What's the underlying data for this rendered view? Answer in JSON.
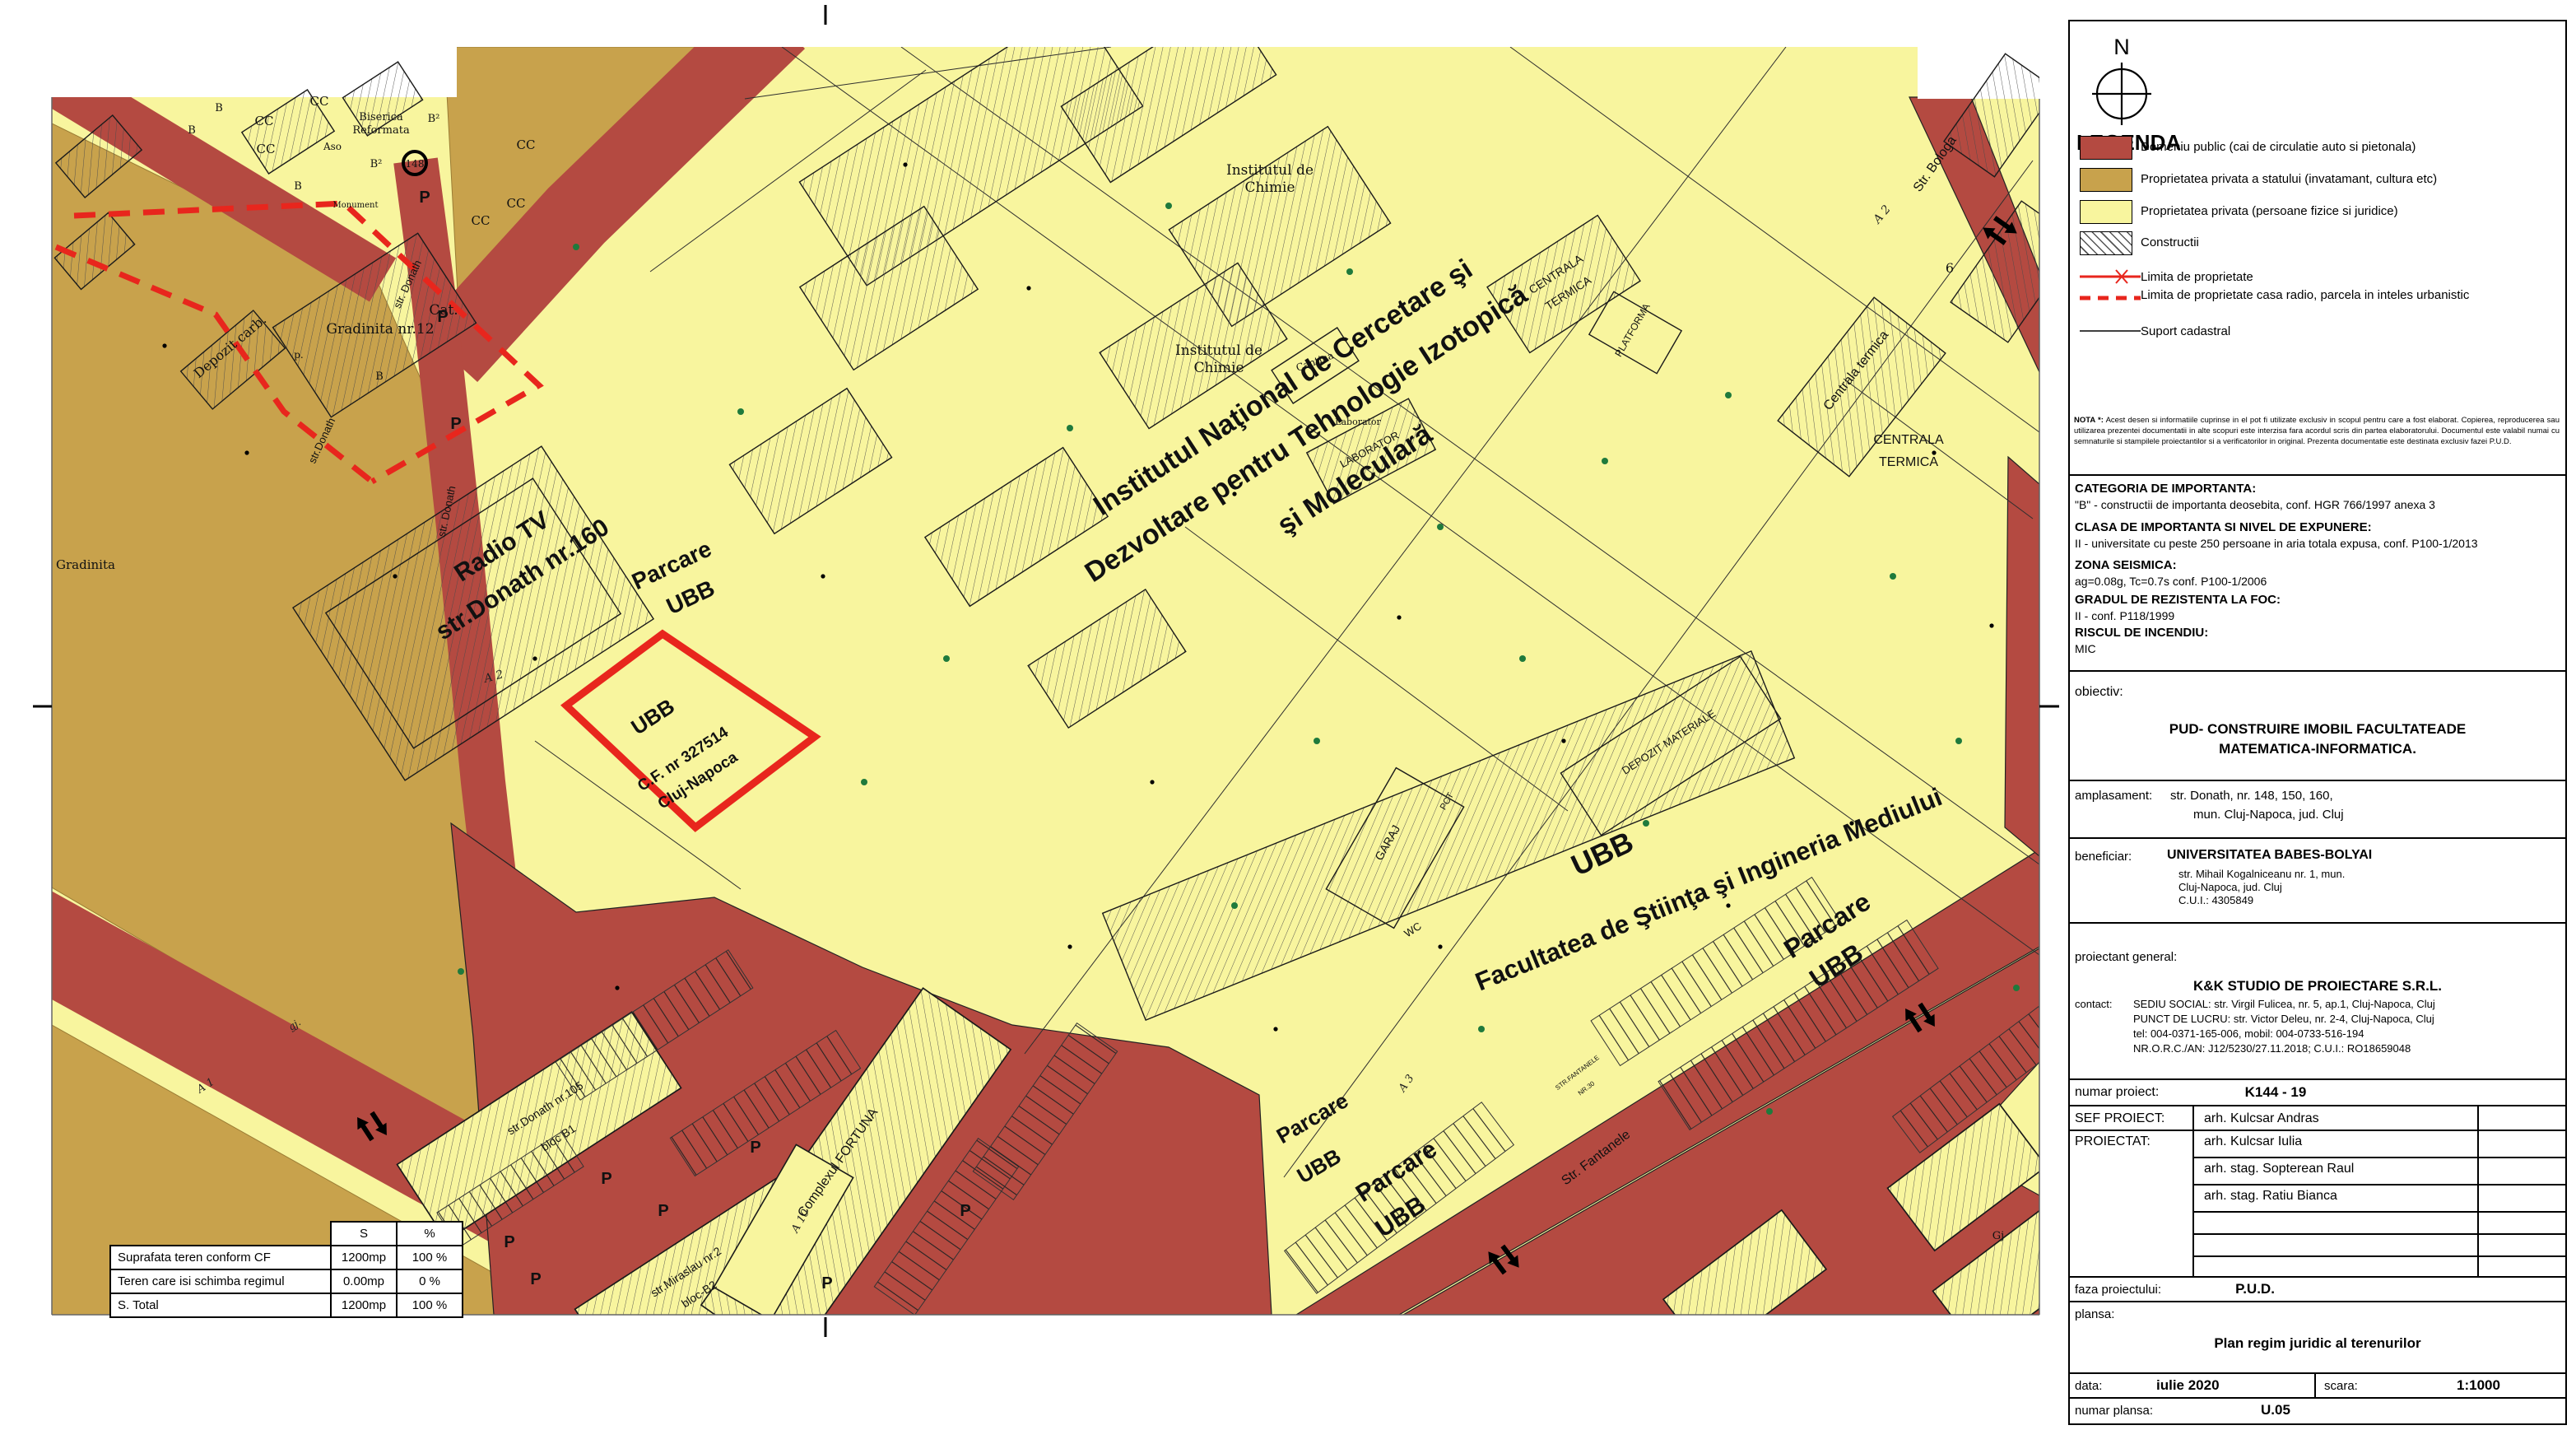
{
  "colors": {
    "public_road": "#b44a41",
    "state_property": "#c8a24c",
    "private_property": "#f8f59e",
    "limit_red": "#e8261d"
  },
  "map": {
    "parking_label": "P",
    "labels": [
      {
        "text": "Radio TV"
      },
      {
        "text": "str.Donath nr.160"
      },
      {
        "text": "UBB"
      },
      {
        "text": "C.F. nr 327514"
      },
      {
        "text": "Cluj-Napoca"
      },
      {
        "text": "Institutul Naţional de Cercetare şi"
      },
      {
        "text": "Dezvoltare pentru Tehnologie Izotopică"
      },
      {
        "text": "şi Moleculară"
      },
      {
        "text": "UBB"
      },
      {
        "text": "Facultatea de Ştiinţa şi Ingineria Mediului"
      },
      {
        "text": "Parcare"
      },
      {
        "text": "UBB"
      },
      {
        "text": "Parcare"
      },
      {
        "text": "UBB"
      },
      {
        "text": "Parcare"
      },
      {
        "text": "UBB"
      },
      {
        "text": "Parcare"
      },
      {
        "text": "UBB"
      },
      {
        "text": "Institutul de"
      },
      {
        "text": "Chimie"
      },
      {
        "text": "Institutul de"
      },
      {
        "text": "Chimie"
      },
      {
        "text": "CENTRALA"
      },
      {
        "text": "TERMICA"
      },
      {
        "text": "Centrala termica"
      },
      {
        "text": "CENTRALA"
      },
      {
        "text": "TERMICA"
      },
      {
        "text": "LABORATOR"
      },
      {
        "text": "Laborator"
      },
      {
        "text": "Cantina"
      },
      {
        "text": "PLATFORMA"
      },
      {
        "text": "DEPOZIT MATERIALE"
      },
      {
        "text": "GARAJ"
      },
      {
        "text": "WC"
      },
      {
        "text": "PCT"
      },
      {
        "text": "Depozit carb."
      },
      {
        "text": "Gradinita nr.12"
      },
      {
        "text": "Cat."
      },
      {
        "text": "Gradinita"
      },
      {
        "text": "Biserica"
      },
      {
        "text": "Reformata"
      },
      {
        "text": "Aso"
      },
      {
        "text": "Monument"
      },
      {
        "text": "CC"
      },
      {
        "text": "CC"
      },
      {
        "text": "CC"
      },
      {
        "text": "CC"
      },
      {
        "text": "CC"
      },
      {
        "text": "CC"
      },
      {
        "text": "B"
      },
      {
        "text": "B"
      },
      {
        "text": "B"
      },
      {
        "text": "B²"
      },
      {
        "text": "B²"
      },
      {
        "text": "148"
      },
      {
        "text": "p."
      },
      {
        "text": "A 2"
      },
      {
        "text": "A 2"
      },
      {
        "text": "A 3"
      },
      {
        "text": "A 1"
      },
      {
        "text": "A 10"
      },
      {
        "text": "6"
      },
      {
        "text": "str. Donath"
      },
      {
        "text": "str.Donath"
      },
      {
        "text": "str. Donath"
      },
      {
        "text": "str.Donath nr.105"
      },
      {
        "text": "bloc B1"
      },
      {
        "text": "str.Miraslau nr.2"
      },
      {
        "text": "bloc-B2"
      },
      {
        "text": "Complexul FORTUNA"
      },
      {
        "text": "Str. Fantanele"
      },
      {
        "text": "STR.FANTANELE"
      },
      {
        "text": "NR.30"
      },
      {
        "text": "Str. Bologa"
      },
      {
        "text": "gj."
      },
      {
        "text": "Gj"
      },
      {
        "text": "B"
      }
    ],
    "area_table": {
      "headers": [
        "",
        "S",
        "%"
      ],
      "rows": [
        [
          "Suprafata teren conform CF",
          "1200mp",
          "100 %"
        ],
        [
          "Teren care isi schimba regimul",
          "0.00mp",
          "0 %"
        ],
        [
          "S. Total",
          "1200mp",
          "100 %"
        ]
      ]
    }
  },
  "panel": {
    "north": "N",
    "legend": {
      "title": "LEGENDA",
      "items": [
        "Domeniu public (cai de circulatie auto si pietonala)",
        "Proprietatea privata a statului (invatamant, cultura etc)",
        "Proprietatea privata (persoane fizice si juridice)",
        "Constructii"
      ],
      "line_items": [
        "Limita de proprietate",
        "Limita de proprietate casa radio, parcela in inteles urbanistic",
        "Suport cadastral"
      ]
    },
    "nota_label": "NOTA *:",
    "nota": "Acest desen si informatiile cuprinse in el pot fi utilizate exclusiv in scopul pentru care a fost elaborat. Copierea, reproducerea sau utilizarea prezentei documentatii in alte scopuri este interzisa fara acordul scris din partea elaboratorului. Documentul este valabil numai cu semnaturile si stampilele proiectantilor si a verificatorilor in original. Prezenta documentatie este destinata exclusiv fazei P.U.D.",
    "info": [
      {
        "h": "CATEGORIA DE IMPORTANTA:",
        "b": "\"B\" - constructii de importanta deosebita, conf. HGR 766/1997 anexa 3"
      },
      {
        "h": "CLASA DE IMPORTANTA SI NIVEL DE EXPUNERE:",
        "b": "II - universitate cu peste 250 persoane in aria totala expusa, conf. P100-1/2013"
      },
      {
        "h": "ZONA SEISMICA:",
        "b": "ag=0.08g, Tc=0.7s conf. P100-1/2006"
      },
      {
        "h": "GRADUL DE REZISTENTA LA FOC:",
        "b": "II - conf. P118/1999"
      },
      {
        "h": "RISCUL DE INCENDIU:",
        "b": "MIC"
      }
    ],
    "obiectiv": {
      "label": "obiectiv:",
      "title1": "PUD- CONSTRUIRE  IMOBIL  FACULTATEADE",
      "title2": "MATEMATICA-INFORMATICA."
    },
    "amplasament": {
      "label": "amplasament:",
      "line1": "str. Donath, nr. 148, 150, 160,",
      "line2": "mun. Cluj-Napoca, jud. Cluj"
    },
    "beneficiar": {
      "label": "beneficiar:",
      "name": "UNIVERSITATEA BABES-BOLYAI",
      "a1": "str. Mihail Kogalniceanu nr. 1, mun.",
      "a2": "Cluj-Napoca, jud. Cluj",
      "a3": "C.U.I.: 4305849"
    },
    "proiectant": {
      "label": "proiectant general:",
      "company": "K&K STUDIO DE PROIECTARE S.R.L.",
      "contact_label": "contact:",
      "c1": "SEDIU SOCIAL: str. Virgil Fulicea, nr. 5, ap.1, Cluj-Napoca, Cluj",
      "c2": "PUNCT DE LUCRU: str. Victor Deleu, nr. 2-4, Cluj-Napoca, Cluj",
      "c3": "tel: 004-0371-165-006, mobil: 004-0733-516-194",
      "c4": "NR.O.R.C./AN: J12/5230/27.11.2018; C.U.I.: RO18659048"
    },
    "numar_proiect": {
      "label": "numar proiect:",
      "value": "K144 - 19"
    },
    "sef": {
      "label": "SEF PROIECT:",
      "name": "arh. Kulcsar Andras"
    },
    "proiectat": {
      "label": "PROIECTAT:",
      "names": [
        "arh. Kulcsar Iulia",
        "arh. stag. Sopterean Raul",
        "arh. stag. Ratiu Bianca"
      ]
    },
    "faza": {
      "label": "faza proiectului:",
      "value": "P.U.D."
    },
    "plansa": {
      "label": "plansa:",
      "title": "Plan regim juridic al terenurilor"
    },
    "data": {
      "label": "data:",
      "value": "iulie 2020"
    },
    "scara": {
      "label": "scara:",
      "value": "1:1000"
    },
    "numar_plansa": {
      "label": "numar plansa:",
      "value": "U.05"
    }
  }
}
